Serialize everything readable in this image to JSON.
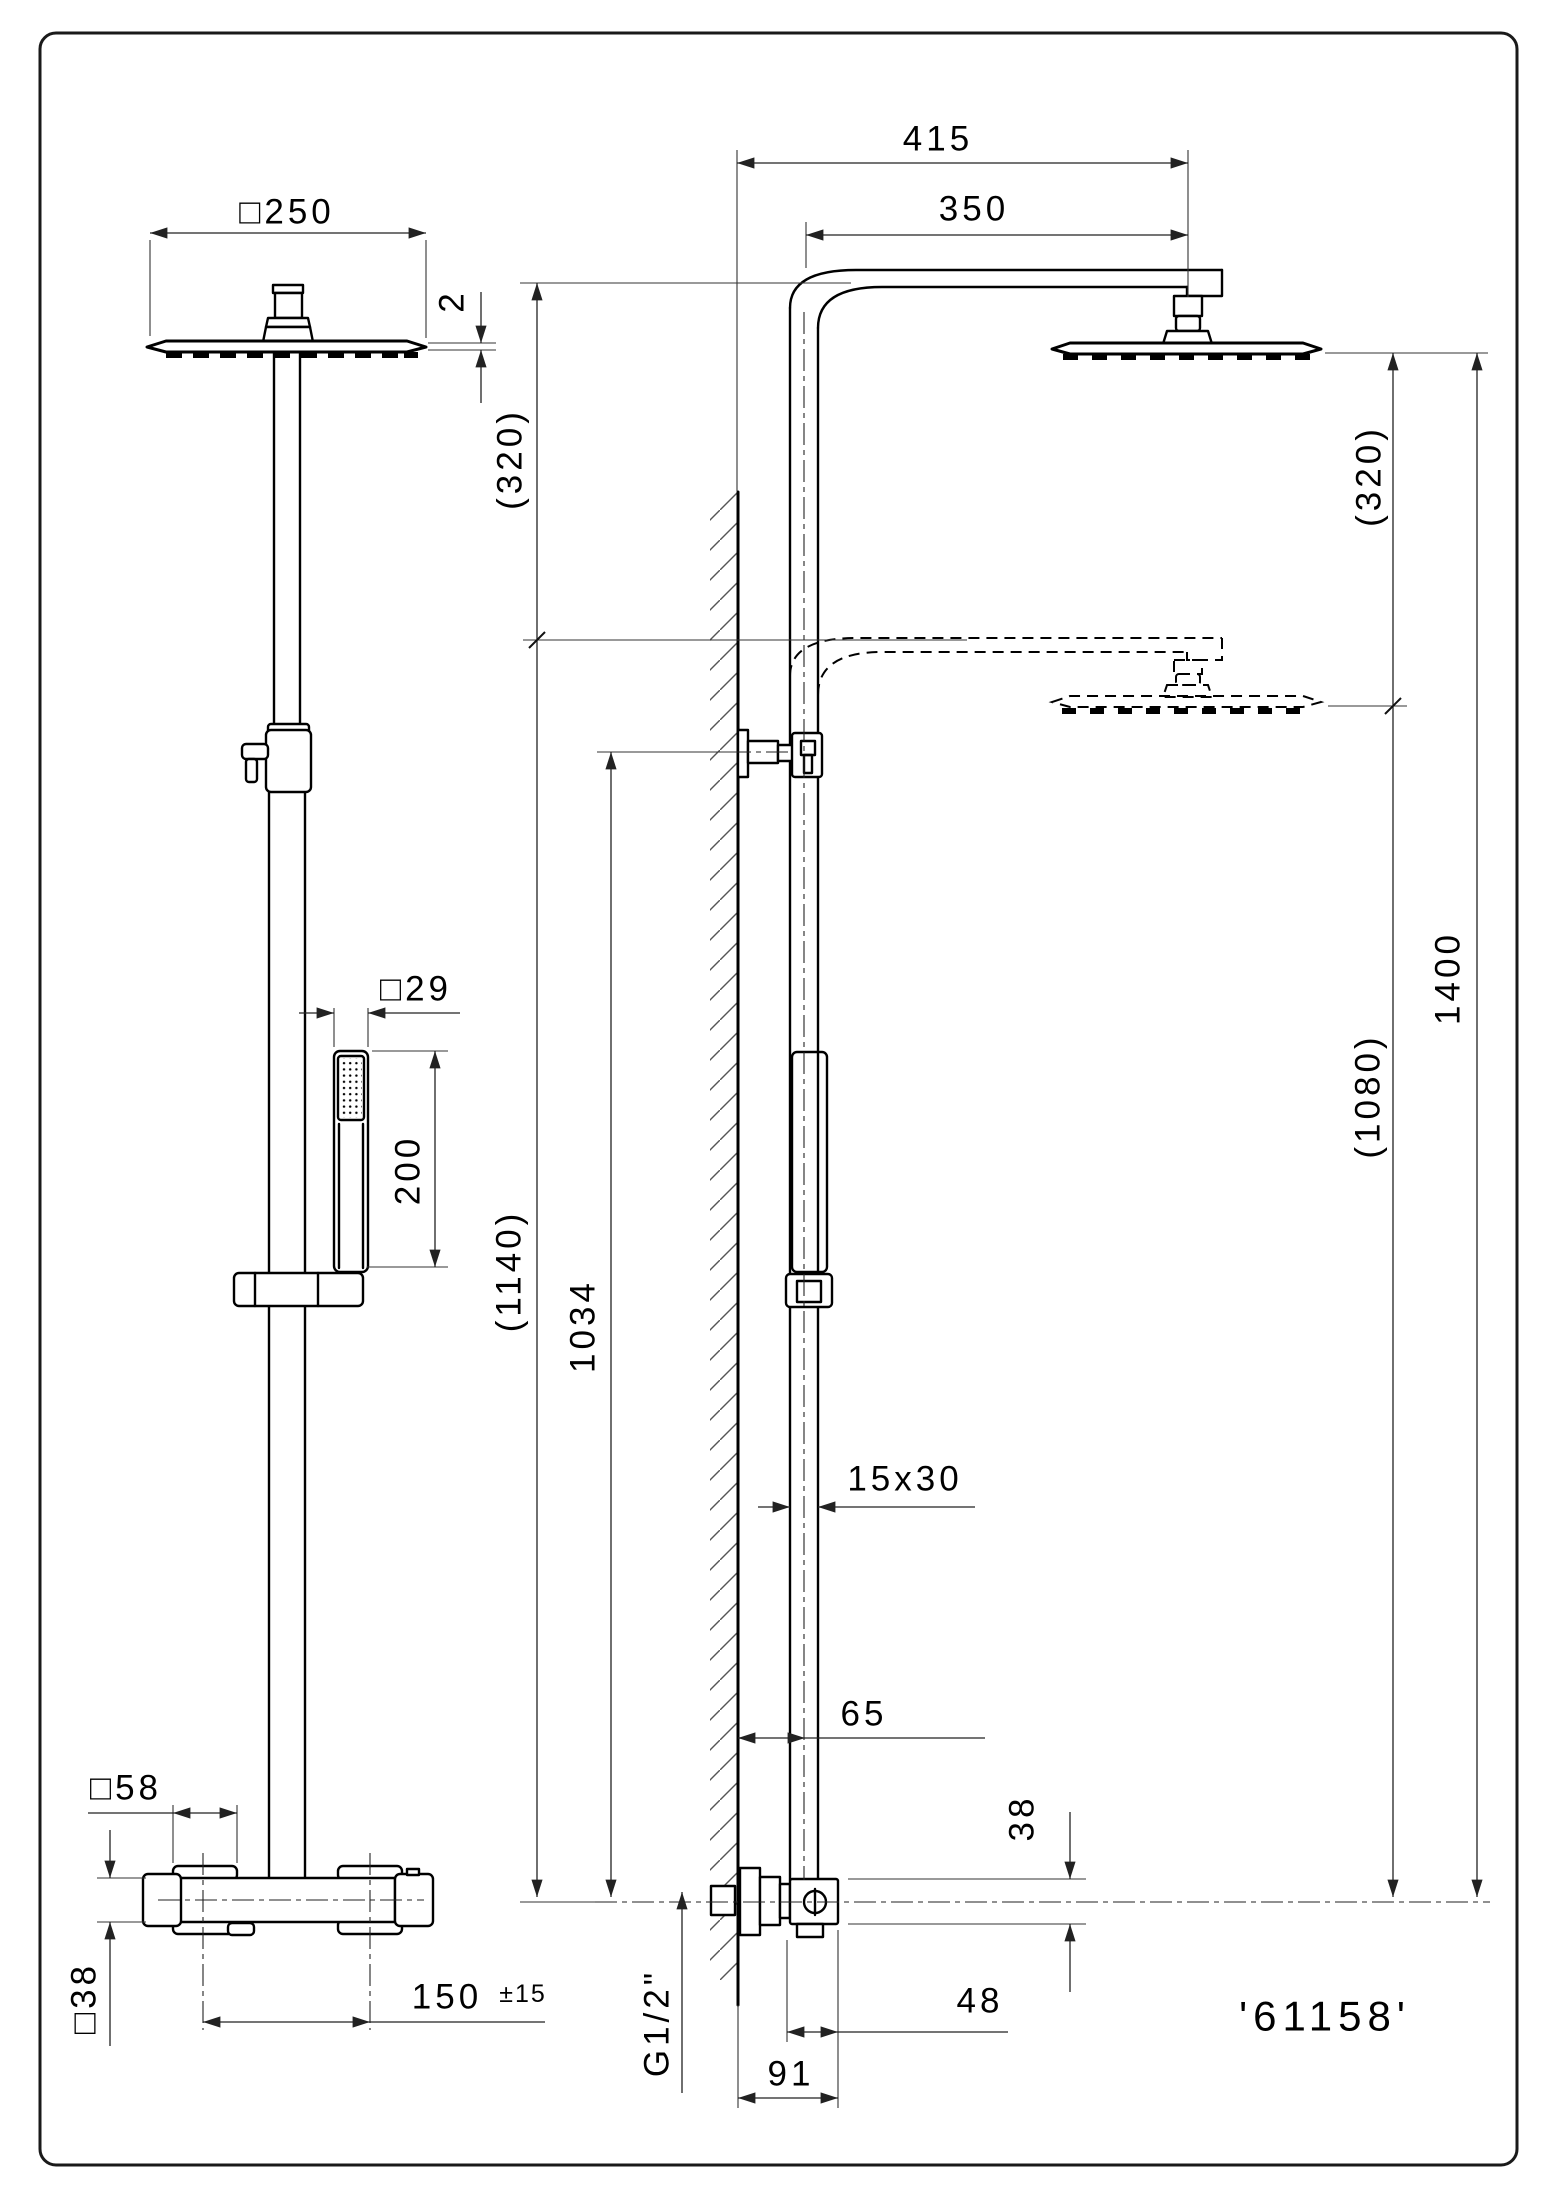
{
  "title": {
    "product_code": "'61158'"
  },
  "front_view": {
    "head_width": "□250",
    "head_thickness": "2",
    "drop": "(320)",
    "handshower_width": "□29",
    "handshower_length": "200",
    "height_lowered": "(1140)",
    "height_bracket": "1034",
    "handle_size": "□58",
    "body_size": "□38",
    "handle_spacing": "150",
    "handle_spacing_tolerance": "±15"
  },
  "side_view": {
    "arm_overall": "415",
    "arm_projection": "350",
    "drop": "(320)",
    "pipe_section": "15x30",
    "wall_offset": "65",
    "height_total": "1400",
    "height_lowered": "(1080)",
    "body_height": "38",
    "body_depth": "48",
    "wall_to_front": "91",
    "inlet_thread": "G1/2\""
  }
}
